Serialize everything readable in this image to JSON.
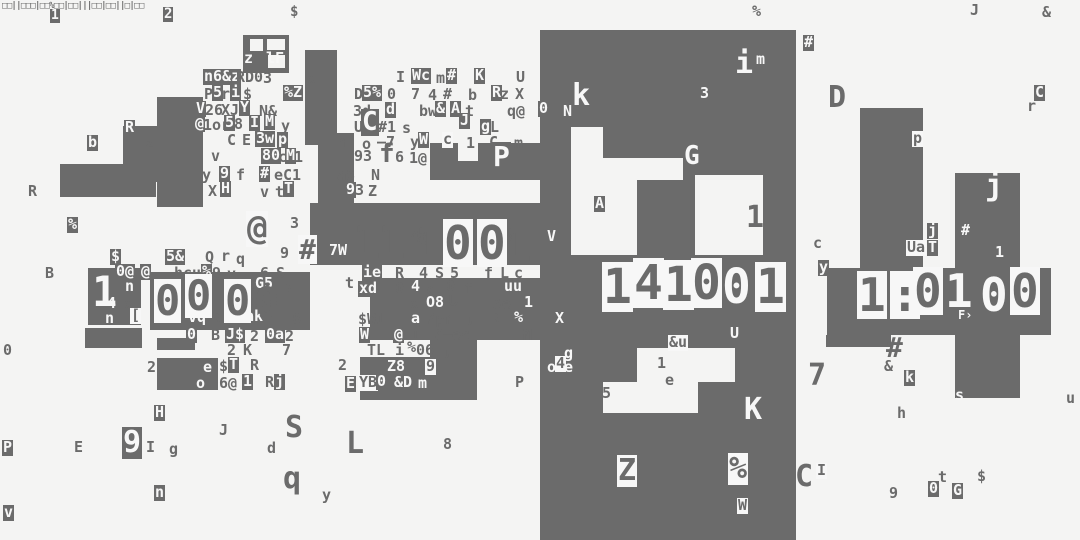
{
  "screen": {
    "kind": "glitch-terminal-noise-art",
    "width": 1080,
    "height": 540,
    "background_color": "#f4f4f3",
    "ink_color": "#6b6b6b",
    "paper_color": "#f7f7f7"
  },
  "digit_groups": [
    {
      "name": "left-digits",
      "reads": "10000",
      "glyphs": [
        [
          92,
          270,
          "1",
          2,
          42
        ],
        [
          154,
          279,
          "0",
          3,
          42
        ],
        [
          185,
          274,
          "0",
          3,
          42
        ],
        [
          224,
          279,
          "0",
          3,
          42
        ],
        [
          254,
          281,
          "0",
          0,
          42
        ]
      ]
    },
    {
      "name": "middle-digits",
      "reads": "111001",
      "glyphs": [
        [
          353,
          218,
          "1",
          0,
          46
        ],
        [
          378,
          218,
          "1",
          0,
          46
        ],
        [
          415,
          220,
          "1",
          0,
          46
        ],
        [
          443,
          219,
          "0",
          3,
          46
        ],
        [
          477,
          219,
          "0",
          3,
          46
        ],
        [
          504,
          221,
          "1",
          0,
          46
        ]
      ]
    },
    {
      "name": "panel-digits",
      "reads": "141001",
      "glyphs": [
        [
          602,
          262,
          "1",
          3,
          48
        ],
        [
          633,
          258,
          "4",
          3,
          48
        ],
        [
          663,
          260,
          "1",
          3,
          48
        ],
        [
          691,
          258,
          "0",
          3,
          48
        ],
        [
          722,
          262,
          "0",
          2,
          48
        ],
        [
          755,
          262,
          "1",
          3,
          48
        ]
      ]
    },
    {
      "name": "right-digits",
      "reads": "1:0100",
      "glyphs": [
        [
          857,
          271,
          "1",
          3,
          46
        ],
        [
          890,
          271,
          ":",
          3,
          46
        ],
        [
          913,
          267,
          "0",
          3,
          46
        ],
        [
          945,
          267,
          "1",
          2,
          46
        ],
        [
          980,
          271,
          "0",
          2,
          46
        ],
        [
          1010,
          267,
          "0",
          3,
          46
        ]
      ]
    }
  ],
  "noise_glyphs": [
    [
      2,
      2,
      "□□||□□□|□□%□□|□□|||□□|□□||□|□□",
      0,
      9,
      -0.7
    ],
    [
      50,
      9,
      "1",
      1,
      13
    ],
    [
      163,
      7,
      "2",
      1,
      14
    ],
    [
      290,
      5,
      "$",
      0,
      14
    ],
    [
      752,
      4,
      "%",
      0
    ],
    [
      970,
      3,
      "J",
      0
    ],
    [
      1042,
      5,
      "&",
      0
    ],
    [
      244,
      51,
      "z",
      2
    ],
    [
      266,
      51,
      "lF",
      2
    ],
    [
      203,
      69,
      "n6&z",
      1
    ],
    [
      236,
      70,
      "RD0",
      0
    ],
    [
      263,
      71,
      "3",
      0
    ],
    [
      307,
      72,
      "x",
      0
    ],
    [
      396,
      70,
      "I",
      0
    ],
    [
      411,
      68,
      "Wc",
      1
    ],
    [
      436,
      71,
      "m",
      0
    ],
    [
      446,
      68,
      "#",
      1
    ],
    [
      474,
      68,
      "K",
      1
    ],
    [
      516,
      70,
      "U",
      0
    ],
    [
      204,
      87,
      "P",
      0
    ],
    [
      212,
      85,
      "5",
      1
    ],
    [
      221,
      87,
      "r",
      0
    ],
    [
      230,
      85,
      "i",
      1
    ],
    [
      243,
      87,
      "$",
      0
    ],
    [
      283,
      85,
      "%Z",
      1
    ],
    [
      354,
      87,
      "D",
      0
    ],
    [
      362,
      85,
      "5%",
      1
    ],
    [
      387,
      87,
      "0",
      0
    ],
    [
      411,
      87,
      "7",
      0
    ],
    [
      428,
      88,
      "4",
      0
    ],
    [
      443,
      87,
      "#",
      0
    ],
    [
      468,
      88,
      "b",
      0
    ],
    [
      491,
      85,
      "R",
      1
    ],
    [
      500,
      87,
      "z",
      0
    ],
    [
      515,
      87,
      "X",
      0
    ],
    [
      195,
      101,
      "V",
      1
    ],
    [
      205,
      103,
      "26",
      0
    ],
    [
      221,
      103,
      "XJ",
      0
    ],
    [
      239,
      100,
      "Y",
      1
    ],
    [
      259,
      104,
      "N&",
      0
    ],
    [
      353,
      104,
      "3d",
      0
    ],
    [
      385,
      102,
      "d",
      1
    ],
    [
      419,
      104,
      "bw",
      0
    ],
    [
      435,
      101,
      "&",
      1
    ],
    [
      450,
      101,
      "A",
      1
    ],
    [
      465,
      104,
      "t",
      0
    ],
    [
      507,
      104,
      "q@",
      0
    ],
    [
      538,
      101,
      "0",
      1
    ],
    [
      563,
      104,
      "N",
      2
    ],
    [
      194,
      116,
      "@",
      1
    ],
    [
      203,
      118,
      "1or",
      0
    ],
    [
      224,
      115,
      "5",
      1
    ],
    [
      234,
      117,
      "8",
      0
    ],
    [
      249,
      115,
      "I",
      1
    ],
    [
      264,
      114,
      "M",
      1
    ],
    [
      281,
      119,
      "y",
      0
    ],
    [
      354,
      120,
      "U",
      0
    ],
    [
      361,
      109,
      "C",
      1,
      26
    ],
    [
      378,
      120,
      "#1",
      0
    ],
    [
      402,
      121,
      "s",
      0
    ],
    [
      459,
      113,
      "J",
      1
    ],
    [
      480,
      119,
      "g",
      1
    ],
    [
      490,
      120,
      "L",
      0
    ],
    [
      572,
      80,
      "k",
      2,
      30
    ],
    [
      700,
      86,
      "3",
      2
    ],
    [
      87,
      135,
      "b",
      1
    ],
    [
      124,
      120,
      "R",
      1
    ],
    [
      145,
      136,
      "z",
      0
    ],
    [
      227,
      133,
      "C",
      0
    ],
    [
      242,
      133,
      "E",
      0
    ],
    [
      255,
      131,
      "3w",
      1
    ],
    [
      277,
      132,
      "p",
      1
    ],
    [
      337,
      135,
      "h",
      0
    ],
    [
      362,
      137,
      "o",
      0
    ],
    [
      377,
      135,
      "–7",
      0
    ],
    [
      410,
      135,
      "y",
      0
    ],
    [
      418,
      132,
      "W",
      1
    ],
    [
      442,
      132,
      "c",
      3
    ],
    [
      466,
      136,
      "1",
      0
    ],
    [
      489,
      135,
      "C",
      0
    ],
    [
      514,
      136,
      "m",
      0
    ],
    [
      211,
      149,
      "v",
      0
    ],
    [
      261,
      148,
      "80",
      1
    ],
    [
      278,
      150,
      "c",
      0
    ],
    [
      285,
      148,
      "M",
      1
    ],
    [
      294,
      150,
      "1",
      0
    ],
    [
      354,
      149,
      "93",
      0
    ],
    [
      379,
      141,
      "f",
      0,
      26
    ],
    [
      395,
      150,
      "6",
      0
    ],
    [
      409,
      151,
      "1@",
      0
    ],
    [
      492,
      142,
      "P",
      1,
      28
    ],
    [
      202,
      168,
      "y",
      0
    ],
    [
      219,
      166,
      "9",
      1
    ],
    [
      236,
      168,
      "f",
      0
    ],
    [
      259,
      166,
      "#",
      1
    ],
    [
      274,
      168,
      "eC1",
      0
    ],
    [
      337,
      168,
      "aS",
      0
    ],
    [
      371,
      168,
      "N",
      0
    ],
    [
      594,
      196,
      "A",
      1
    ],
    [
      28,
      184,
      "R",
      0
    ],
    [
      208,
      184,
      "X",
      0
    ],
    [
      220,
      181,
      "H",
      1
    ],
    [
      260,
      185,
      "v",
      0
    ],
    [
      275,
      185,
      "t",
      0
    ],
    [
      283,
      181,
      "T",
      1
    ],
    [
      345,
      182,
      "9",
      1
    ],
    [
      355,
      183,
      "3",
      0
    ],
    [
      368,
      184,
      "Z",
      0
    ],
    [
      67,
      217,
      "%",
      1
    ],
    [
      110,
      249,
      "$",
      1
    ],
    [
      246,
      211,
      "@",
      3,
      34
    ],
    [
      290,
      216,
      "3",
      0
    ],
    [
      280,
      246,
      "9",
      0
    ],
    [
      45,
      266,
      "B",
      0
    ],
    [
      298,
      235,
      "#",
      3,
      28
    ],
    [
      328,
      243,
      "7W",
      1
    ],
    [
      410,
      230,
      "4@",
      0
    ],
    [
      504,
      232,
      "8",
      0
    ],
    [
      345,
      276,
      "t",
      0
    ],
    [
      165,
      249,
      "5&",
      1
    ],
    [
      205,
      250,
      "Q",
      0
    ],
    [
      221,
      249,
      "r",
      0
    ],
    [
      236,
      252,
      "q",
      0
    ],
    [
      547,
      229,
      "V",
      2
    ],
    [
      115,
      264,
      "0@",
      1
    ],
    [
      140,
      264,
      "@",
      1
    ],
    [
      174,
      266,
      "hcu",
      0
    ],
    [
      201,
      264,
      "%",
      1
    ],
    [
      212,
      266,
      "9",
      0
    ],
    [
      227,
      267,
      "v",
      0
    ],
    [
      260,
      266,
      "6",
      0
    ],
    [
      276,
      266,
      "S",
      0
    ],
    [
      362,
      265,
      "ie",
      1
    ],
    [
      395,
      266,
      "R",
      0
    ],
    [
      419,
      266,
      "4",
      0
    ],
    [
      435,
      266,
      "S",
      0
    ],
    [
      450,
      266,
      "5",
      0
    ],
    [
      484,
      266,
      "f",
      0
    ],
    [
      500,
      266,
      "L",
      0
    ],
    [
      514,
      266,
      "c",
      0
    ],
    [
      125,
      279,
      "n",
      2
    ],
    [
      160,
      279,
      "uu",
      0
    ],
    [
      188,
      275,
      "a",
      0
    ],
    [
      232,
      277,
      "0us",
      0
    ],
    [
      254,
      276,
      "G5",
      1
    ],
    [
      283,
      280,
      "5",
      0
    ],
    [
      107,
      296,
      "4",
      2
    ],
    [
      124,
      297,
      "x",
      0
    ],
    [
      245,
      296,
      "9h",
      0
    ],
    [
      105,
      311,
      "n",
      2
    ],
    [
      130,
      308,
      "[",
      3
    ],
    [
      358,
      281,
      "xd",
      1
    ],
    [
      395,
      281,
      "0",
      0
    ],
    [
      410,
      279,
      "4",
      1
    ],
    [
      427,
      283,
      "q",
      0
    ],
    [
      446,
      279,
      "0",
      0
    ],
    [
      464,
      281,
      "f",
      0
    ],
    [
      504,
      279,
      "uu",
      2
    ],
    [
      410,
      297,
      "x",
      0
    ],
    [
      425,
      295,
      "O8",
      1
    ],
    [
      449,
      294,
      "U",
      0
    ],
    [
      493,
      297,
      "Ae",
      0
    ],
    [
      523,
      295,
      "1",
      1
    ],
    [
      187,
      310,
      "vq",
      1
    ],
    [
      211,
      312,
      "B",
      0
    ],
    [
      226,
      310,
      "74",
      0
    ],
    [
      235,
      309,
      "%ak",
      1
    ],
    [
      292,
      312,
      "6",
      0
    ],
    [
      358,
      312,
      "$W1",
      0
    ],
    [
      410,
      311,
      "a",
      1
    ],
    [
      426,
      312,
      "7pr",
      0
    ],
    [
      466,
      313,
      "u",
      0
    ],
    [
      490,
      312,
      "B",
      0
    ],
    [
      513,
      310,
      "%",
      1
    ],
    [
      555,
      311,
      "X",
      2
    ],
    [
      958,
      309,
      "F›",
      2,
      12
    ],
    [
      186,
      327,
      "0",
      1
    ],
    [
      211,
      328,
      "B",
      0
    ],
    [
      225,
      327,
      "J$",
      1
    ],
    [
      250,
      329,
      "2",
      0
    ],
    [
      265,
      327,
      "0a",
      1
    ],
    [
      285,
      329,
      "2",
      0
    ],
    [
      359,
      327,
      "W",
      1
    ],
    [
      393,
      327,
      "@",
      1
    ],
    [
      411,
      328,
      "I",
      0
    ],
    [
      434,
      328,
      "G—ec",
      0
    ],
    [
      523,
      328,
      "M",
      0
    ],
    [
      668,
      335,
      "&u",
      3
    ],
    [
      729,
      326,
      "U",
      1
    ],
    [
      818,
      260,
      "y",
      1
    ],
    [
      3,
      343,
      "0",
      0
    ],
    [
      227,
      343,
      "2",
      0
    ],
    [
      243,
      343,
      "K",
      0
    ],
    [
      282,
      343,
      "7",
      0
    ],
    [
      367,
      343,
      "TL",
      0
    ],
    [
      395,
      343,
      "i",
      0
    ],
    [
      407,
      340,
      "%",
      0
    ],
    [
      416,
      343,
      "06",
      0
    ],
    [
      443,
      346,
      "u",
      0
    ],
    [
      564,
      346,
      "g",
      2
    ],
    [
      886,
      333,
      "#",
      0,
      28
    ],
    [
      147,
      360,
      "2",
      0
    ],
    [
      203,
      360,
      "e",
      2
    ],
    [
      196,
      376,
      "o",
      2
    ],
    [
      219,
      359,
      "$",
      0
    ],
    [
      228,
      357,
      "T",
      1
    ],
    [
      250,
      358,
      "R",
      0
    ],
    [
      338,
      358,
      "2",
      0
    ],
    [
      386,
      359,
      "Z8",
      1
    ],
    [
      425,
      359,
      "9",
      3
    ],
    [
      547,
      360,
      "o",
      2
    ],
    [
      555,
      356,
      "4",
      3
    ],
    [
      564,
      360,
      "e",
      2
    ],
    [
      657,
      356,
      "1",
      0
    ],
    [
      665,
      373,
      "e",
      0
    ],
    [
      746,
      202,
      "1",
      0,
      30
    ],
    [
      884,
      359,
      "&",
      0
    ],
    [
      808,
      360,
      "7",
      0,
      30
    ],
    [
      904,
      370,
      "k",
      1
    ],
    [
      955,
      388,
      "s",
      2
    ],
    [
      1066,
      391,
      "u",
      0
    ],
    [
      219,
      376,
      "6@",
      0
    ],
    [
      242,
      374,
      "1",
      1
    ],
    [
      265,
      375,
      "R",
      0
    ],
    [
      274,
      374,
      "j",
      1
    ],
    [
      345,
      376,
      "E",
      1
    ],
    [
      358,
      375,
      "YB",
      3
    ],
    [
      376,
      374,
      "0",
      1
    ],
    [
      394,
      375,
      "&D",
      2
    ],
    [
      418,
      376,
      "m",
      2
    ],
    [
      515,
      375,
      "P",
      0
    ],
    [
      602,
      386,
      "5",
      0
    ],
    [
      744,
      394,
      "K",
      2,
      30
    ],
    [
      897,
      406,
      "h",
      0
    ],
    [
      154,
      405,
      "H",
      1
    ],
    [
      285,
      412,
      "S",
      0,
      30
    ],
    [
      219,
      423,
      "J",
      0
    ],
    [
      346,
      428,
      "L",
      0,
      30
    ],
    [
      2,
      440,
      "P",
      1
    ],
    [
      74,
      440,
      "E",
      0
    ],
    [
      122,
      427,
      "9",
      1,
      30
    ],
    [
      146,
      440,
      "I",
      0
    ],
    [
      169,
      442,
      "g",
      0
    ],
    [
      267,
      441,
      "d",
      0
    ],
    [
      443,
      437,
      "8",
      0
    ],
    [
      283,
      463,
      "q",
      0,
      30
    ],
    [
      322,
      488,
      "y",
      0
    ],
    [
      154,
      485,
      "n",
      1
    ],
    [
      3,
      505,
      "v",
      1
    ],
    [
      683,
      143,
      "G",
      1,
      26
    ],
    [
      617,
      455,
      "Z",
      3,
      30
    ],
    [
      728,
      453,
      "%",
      3,
      30
    ],
    [
      737,
      498,
      "W",
      3
    ],
    [
      735,
      48,
      "i",
      2,
      30
    ],
    [
      756,
      52,
      "m",
      2
    ],
    [
      803,
      35,
      "#",
      1
    ],
    [
      828,
      82,
      "D",
      0,
      30
    ],
    [
      1034,
      85,
      "C",
      1
    ],
    [
      1027,
      99,
      "r",
      0
    ],
    [
      912,
      131,
      "p",
      3
    ],
    [
      985,
      170,
      "j",
      2,
      30
    ],
    [
      960,
      223,
      "#",
      1
    ],
    [
      995,
      245,
      "1",
      2
    ],
    [
      927,
      223,
      "j",
      1
    ],
    [
      927,
      240,
      "T",
      1
    ],
    [
      906,
      240,
      "Ua",
      3
    ],
    [
      813,
      236,
      "c",
      0
    ],
    [
      795,
      461,
      "C",
      0,
      30
    ],
    [
      816,
      463,
      "I",
      3
    ],
    [
      938,
      470,
      "t",
      0
    ],
    [
      977,
      469,
      "$",
      0
    ],
    [
      889,
      486,
      "9",
      0
    ],
    [
      928,
      481,
      "0",
      1
    ],
    [
      952,
      483,
      "G",
      1
    ]
  ],
  "blocks": [
    [
      243,
      35,
      46,
      38
    ],
    [
      157,
      97,
      46,
      110
    ],
    [
      123,
      126,
      34,
      56
    ],
    [
      60,
      164,
      96,
      33
    ],
    [
      305,
      50,
      32,
      95
    ],
    [
      318,
      133,
      36,
      72
    ],
    [
      430,
      143,
      115,
      37
    ],
    [
      310,
      203,
      235,
      62
    ],
    [
      88,
      268,
      53,
      57
    ],
    [
      150,
      272,
      160,
      58
    ],
    [
      85,
      328,
      57,
      20
    ],
    [
      157,
      338,
      38,
      12
    ],
    [
      157,
      358,
      61,
      32
    ],
    [
      370,
      278,
      50,
      62
    ],
    [
      420,
      278,
      125,
      62
    ],
    [
      430,
      340,
      47,
      17
    ],
    [
      360,
      357,
      117,
      43
    ],
    [
      540,
      30,
      256,
      510
    ],
    [
      860,
      108,
      63,
      162
    ],
    [
      955,
      173,
      65,
      225
    ],
    [
      827,
      268,
      224,
      67
    ],
    [
      826,
      335,
      65,
      12
    ]
  ],
  "cutouts": [
    [
      250,
      39,
      13,
      12
    ],
    [
      267,
      39,
      18,
      11
    ],
    [
      268,
      55,
      17,
      13
    ],
    [
      571,
      127,
      32,
      128
    ],
    [
      603,
      158,
      34,
      97
    ],
    [
      637,
      158,
      46,
      22
    ],
    [
      695,
      175,
      68,
      80
    ],
    [
      637,
      348,
      98,
      34
    ],
    [
      603,
      382,
      95,
      31
    ],
    [
      458,
      143,
      20,
      18
    ]
  ]
}
